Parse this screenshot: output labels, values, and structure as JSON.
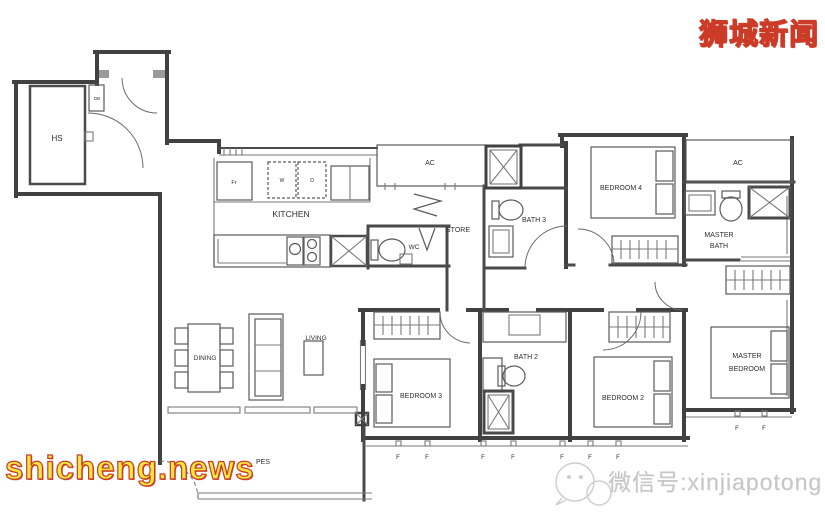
{
  "page": {
    "width": 825,
    "height": 512,
    "background": "#ffffff"
  },
  "branding": {
    "logo_text": "狮城新闻",
    "site_url": "shicheng.news",
    "wechat_label": "微信号:xinjiapotong",
    "logo_fill_color": "#f2e73c",
    "logo_outline_color": "#cc3a28",
    "watermark_color": "#c7c7c7"
  },
  "floorplan": {
    "wall_color": "#414141",
    "label_color": "#2e2e2e",
    "labels": {
      "hs": "HS",
      "db": "DB",
      "kitchen": "KITCHEN",
      "fridge": "Fr",
      "washer": "W",
      "dryer": "D",
      "wc": "WC",
      "store": "STORE",
      "ac": "AC",
      "bath3": "BATH 3",
      "bedroom4": "BEDROOM 4",
      "master_bath_line1": "MASTER",
      "master_bath_line2": "BATH",
      "dining": "DINING",
      "living": "LIVING",
      "bedroom3": "BEDROOM 3",
      "bath2": "BATH 2",
      "bedroom2": "BEDROOM 2",
      "master_bedroom_line1": "MASTER",
      "master_bedroom_line2": "BEDROOM",
      "pes": "PES",
      "fixed_window": "F"
    }
  }
}
